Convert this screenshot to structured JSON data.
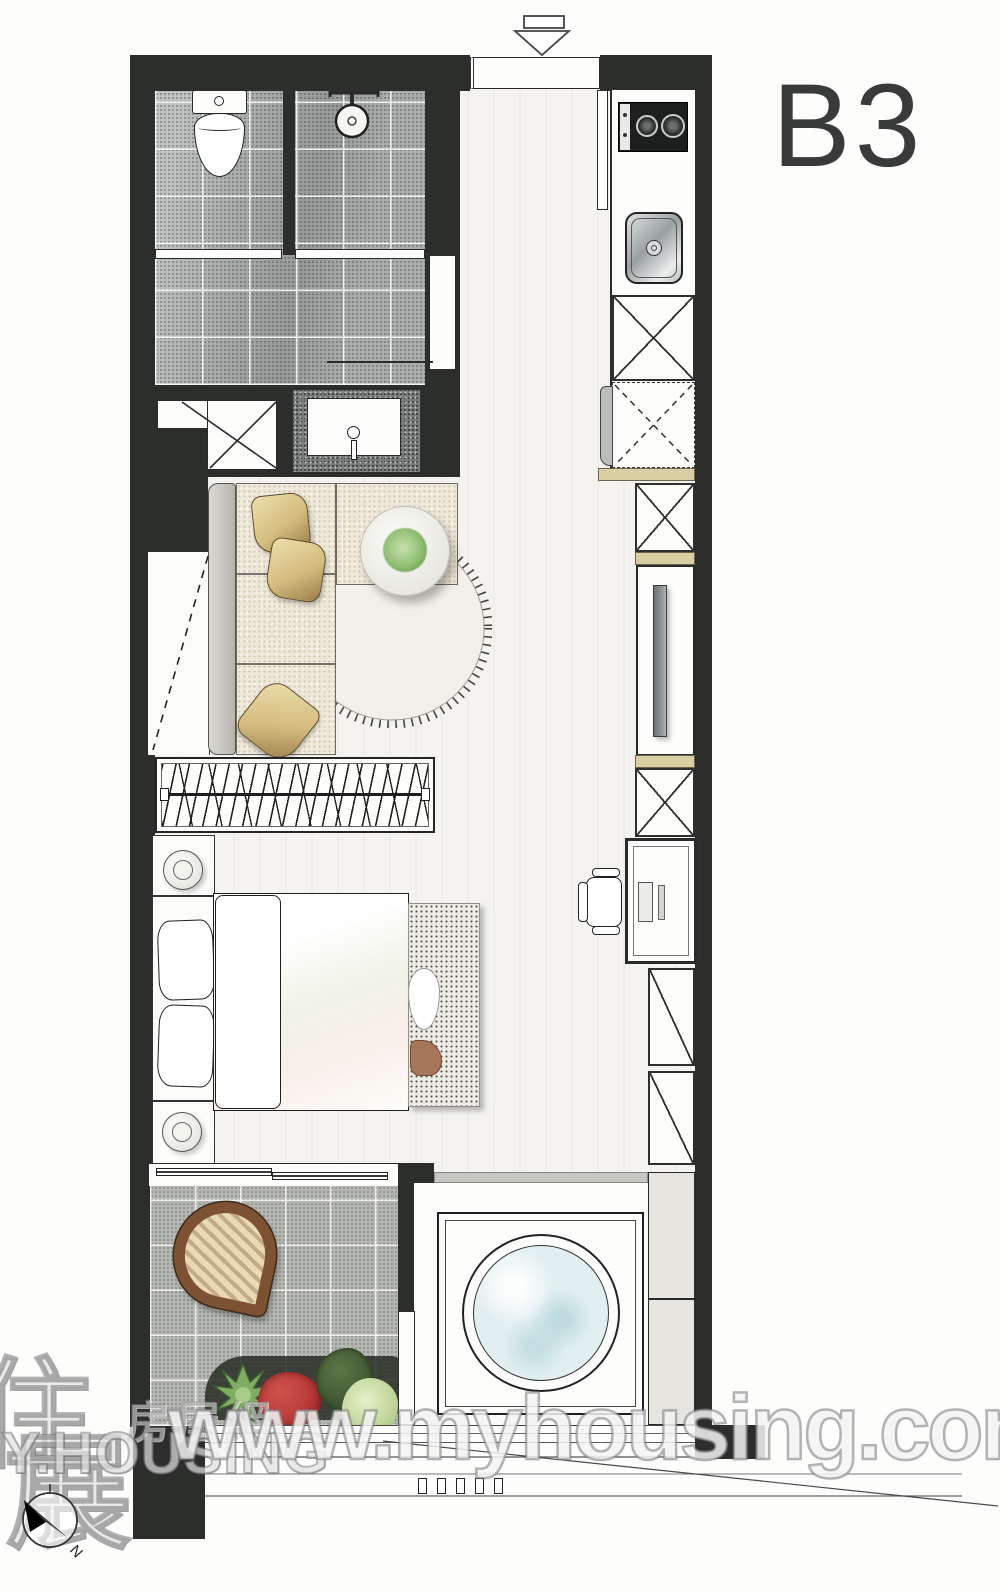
{
  "meta": {
    "unit_label": "B3"
  },
  "watermark": {
    "site_url": "www.myhousing.com.tw",
    "logo_char_top": "住",
    "logo_char_bottom": "展",
    "logo_cjk_suffix": "房屋網",
    "logo_latin": "MY.HOUSING"
  },
  "compass": {
    "north_label": "N"
  },
  "colors": {
    "wall": "#2b2e2b",
    "bath_tile": "#a9aeac",
    "balcony_tile": "#b4b6b1",
    "floor": "#f4f3ef",
    "counter_tan": "#d9cfa2",
    "sofa_fabric": "#efe9da",
    "pillow_tan": "#d5bd7e",
    "plant_green": "#8fbf72",
    "flower_red": "#b9393a",
    "washer_drum": "#e2eff0",
    "rattan_brown": "#7c5233",
    "tv_gray": "#8d9294"
  }
}
